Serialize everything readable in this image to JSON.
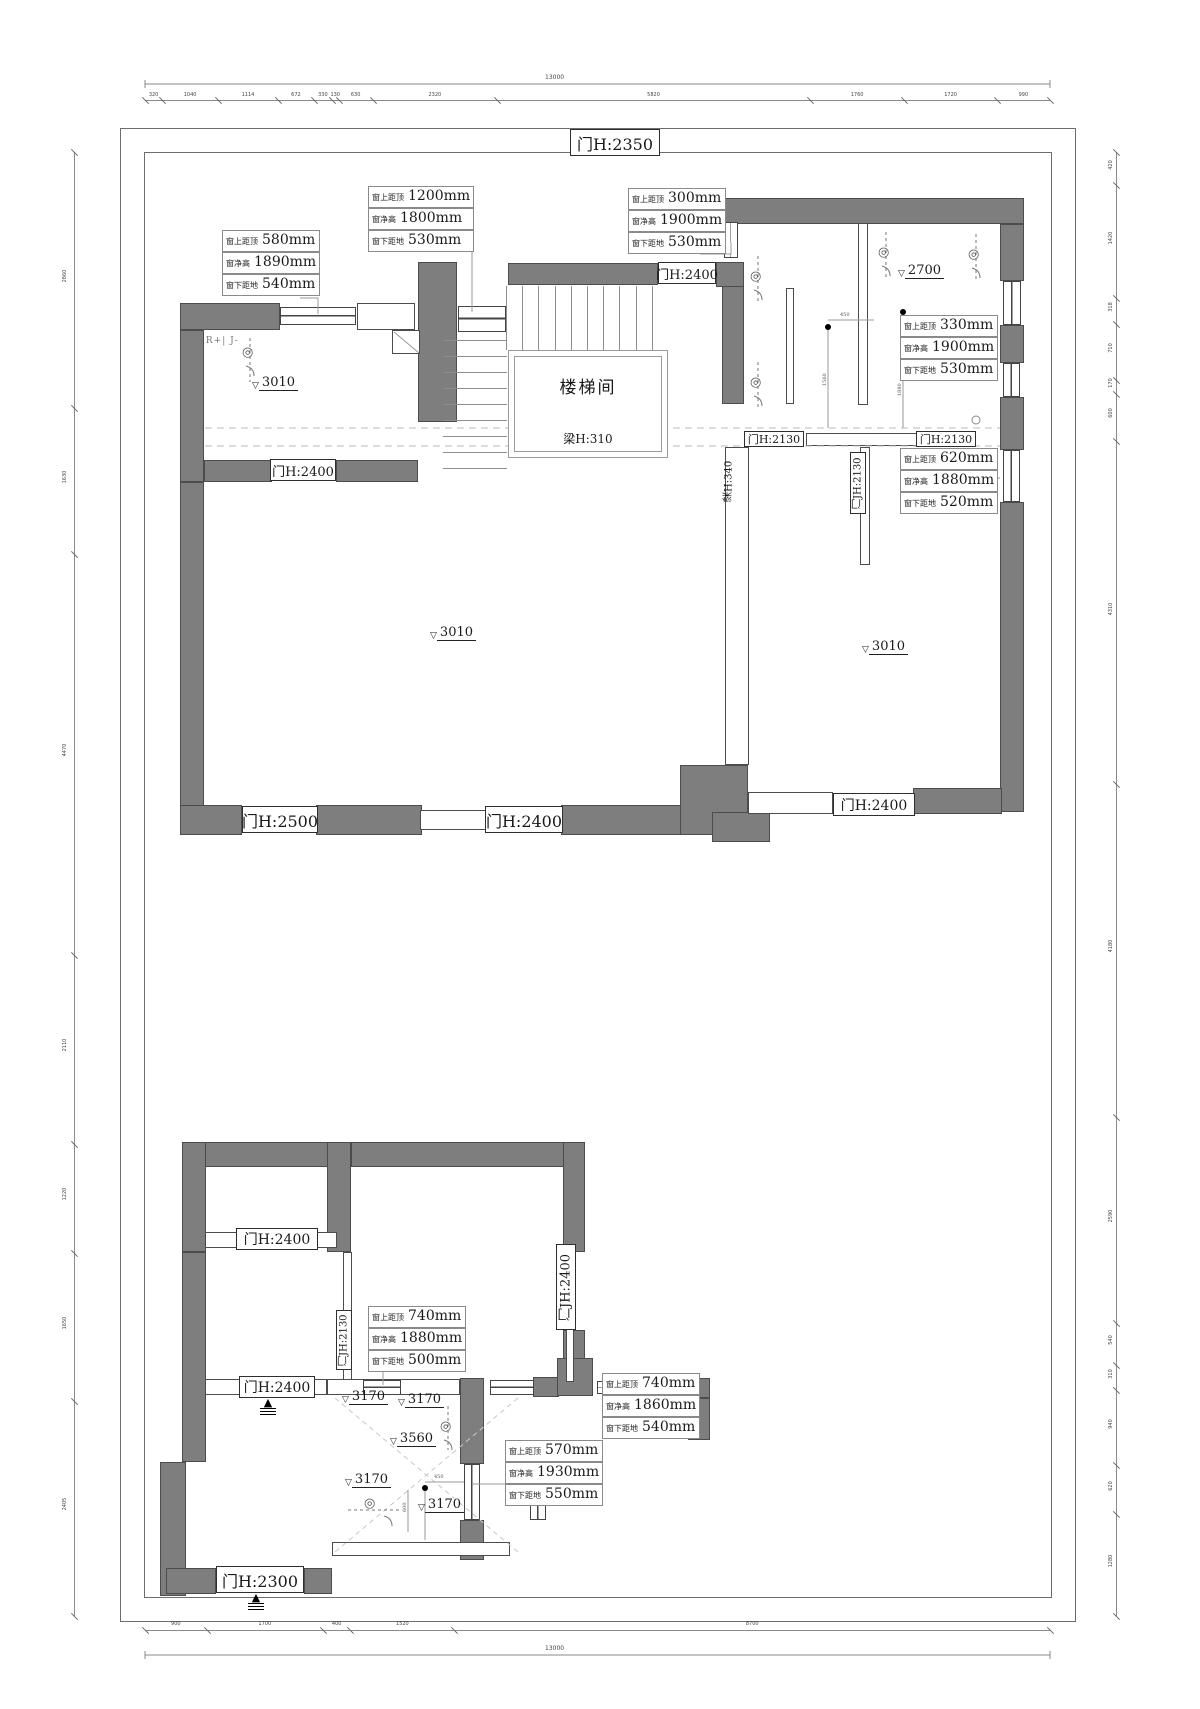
{
  "icons": {
    "shower": "◎",
    "triangle": "▽",
    "arrow": "▲",
    "knob": "○"
  },
  "ann_labels": {
    "top": "窗上距顶",
    "mid": "窗净高",
    "bot": "窗下距地"
  },
  "annotations": {
    "a1": [
      "580mm",
      "1890mm",
      "540mm"
    ],
    "a2": [
      "1200mm",
      "1800mm",
      "530mm"
    ],
    "a3": [
      "300mm",
      "1900mm",
      "530mm"
    ],
    "a4": [
      "330mm",
      "1900mm",
      "530mm"
    ],
    "a5": [
      "620mm",
      "1880mm",
      "520mm"
    ],
    "a6": [
      "740mm",
      "1880mm",
      "500mm"
    ],
    "a7": [
      "740mm",
      "1860mm",
      "540mm"
    ],
    "a8": [
      "570mm",
      "1930mm",
      "550mm"
    ]
  },
  "doors": {
    "d1": "门H:2350",
    "d2": "门H:2400",
    "d3": "门H:2400",
    "d4": "门H:2130",
    "d5": "门H:2130",
    "d6": "门H:2500",
    "d7": "门H:2400",
    "d8": "门H:2400",
    "d9": "门H:2400",
    "d10": "门H:2400",
    "d11": "门H:2300",
    "v1": "门JH:2130",
    "v2": "门JH:2130",
    "v3": "门JH:2400"
  },
  "beams": {
    "b1": "梁H:310",
    "b2": "梁H:340"
  },
  "rooms": {
    "stairwell": "楼梯间"
  },
  "elevations": {
    "e1": "3010",
    "e2": "3010",
    "e3": "3010",
    "e4": "2700",
    "e5": "3170",
    "e6": "3170",
    "e7": "3560",
    "e8": "3170",
    "e9": "3170"
  },
  "fixture_label": "- R+| J-",
  "small_dims": {
    "d450a": "450",
    "d1560": "1560",
    "d1880": "1880",
    "d450b": "450",
    "d600": "600"
  },
  "dimensions": {
    "top": {
      "total": "13000",
      "values": [
        "320",
        "1040",
        "1114",
        "672",
        "330",
        "130",
        "630",
        "2320",
        "5820",
        "1760",
        "1720",
        "990"
      ]
    },
    "bottom": {
      "total": "13000",
      "values": [
        "900",
        "1700",
        "400",
        "1520",
        "8700"
      ]
    },
    "left": {
      "values": [
        "2860",
        "1630",
        "4470",
        "2110",
        "1220",
        "1650",
        "2405"
      ]
    },
    "right": {
      "values": [
        "420",
        "1420",
        "318",
        "710",
        "170",
        "600",
        "4310",
        "4180",
        "2590",
        "540",
        "310",
        "940",
        "620",
        "1280"
      ]
    }
  }
}
